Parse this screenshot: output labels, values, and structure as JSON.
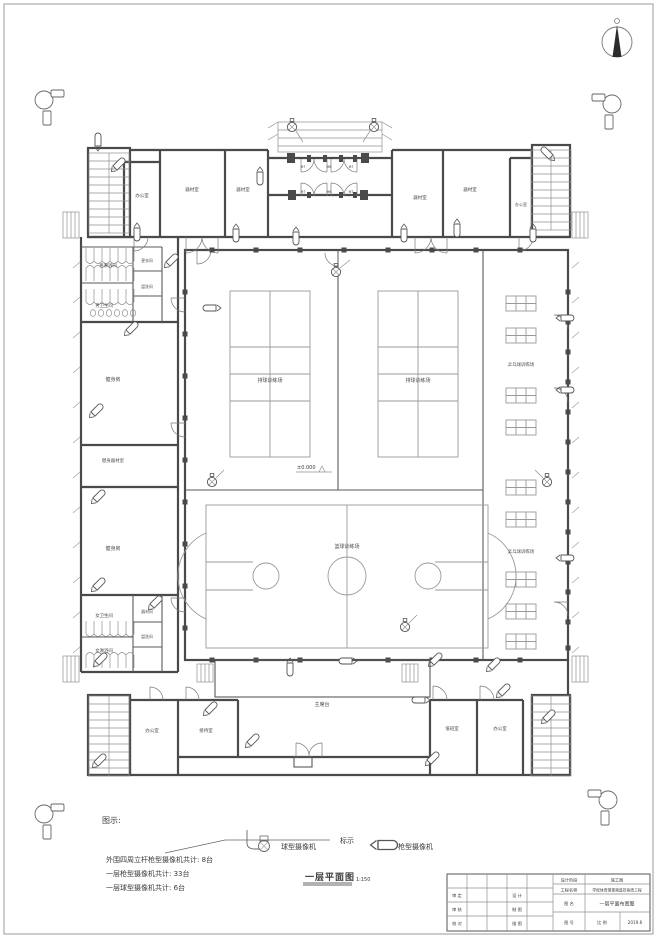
{
  "labels": {
    "office": "办公室",
    "equipment": "器材室",
    "mens_shower": "男淋浴间",
    "mens_toilet": "男卫生间",
    "changing": "更衣间",
    "washroom": "盥洗间",
    "gym": "健身房",
    "gym_equipment": "健身器材室",
    "womens_toilet": "女卫生间",
    "womens_shower": "女淋浴间",
    "storage": "器材间",
    "reception": "接待室",
    "duty": "值班室",
    "rostrum": "主席台",
    "volleyball": "排球训练场",
    "basketball": "篮球训练场",
    "table_tennis": "乒乓球训练场",
    "elevation": "±0.000",
    "m6": "M6",
    "m7": "M7"
  },
  "legend": {
    "heading": "图示:",
    "mark": "标示",
    "dome": "球型摄像机",
    "bullet": "枪型摄像机",
    "count_pole": "外围四周立杆枪型摄像机共计: 8台",
    "count_gun": "一层枪型摄像机共计: 33台",
    "count_dome": "一层球型摄像机共计: 6台",
    "title": "一层平面图",
    "scale": "1:150"
  },
  "titleblock": {
    "review": [
      "审 定",
      "审 核",
      "校 对"
    ],
    "draft": [
      "设 计",
      "制 图",
      "描 图"
    ],
    "stage_label": "设计阶段",
    "stage_value": "施工图",
    "project_label": "工程名称",
    "project_value": "学校体育馆视频监控系统工程",
    "drawing_label": "图 名",
    "drawing_value": "一层平面布置图",
    "number_label": "图 号",
    "scale_label": "比 例",
    "date_value": "2019.6"
  }
}
